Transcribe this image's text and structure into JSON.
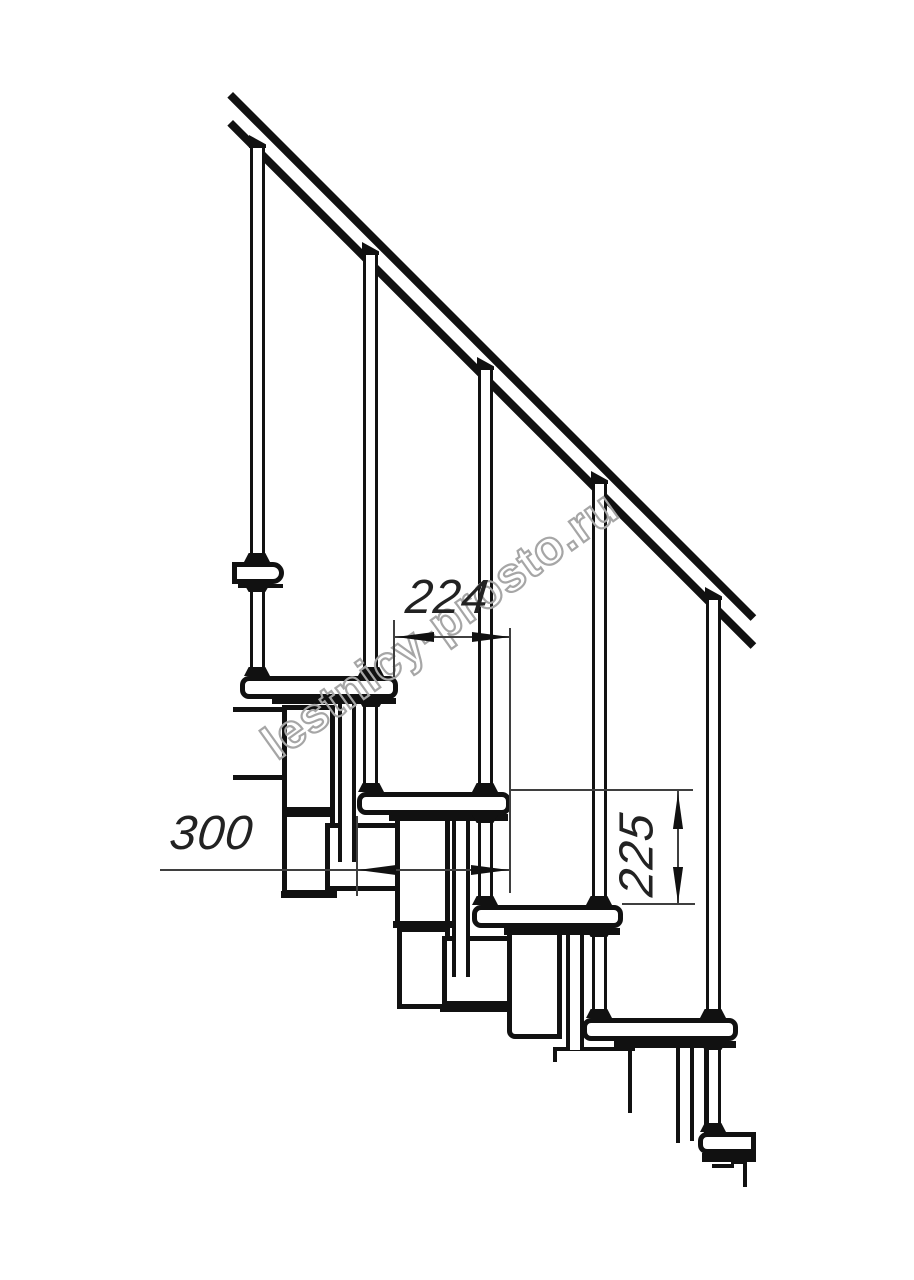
{
  "drawing": {
    "type": "technical-side-view-of-modular-staircase",
    "background_color": "#ffffff",
    "line_color": "#111111",
    "dimension_line_color": "#3f3f3f",
    "watermark_color": "#a6a6a6"
  },
  "watermark": {
    "text": "lestnicy-prosto.ru"
  },
  "dimensions": {
    "horizontal_between_treads": "224",
    "module_length": "300",
    "step_height": "225"
  }
}
